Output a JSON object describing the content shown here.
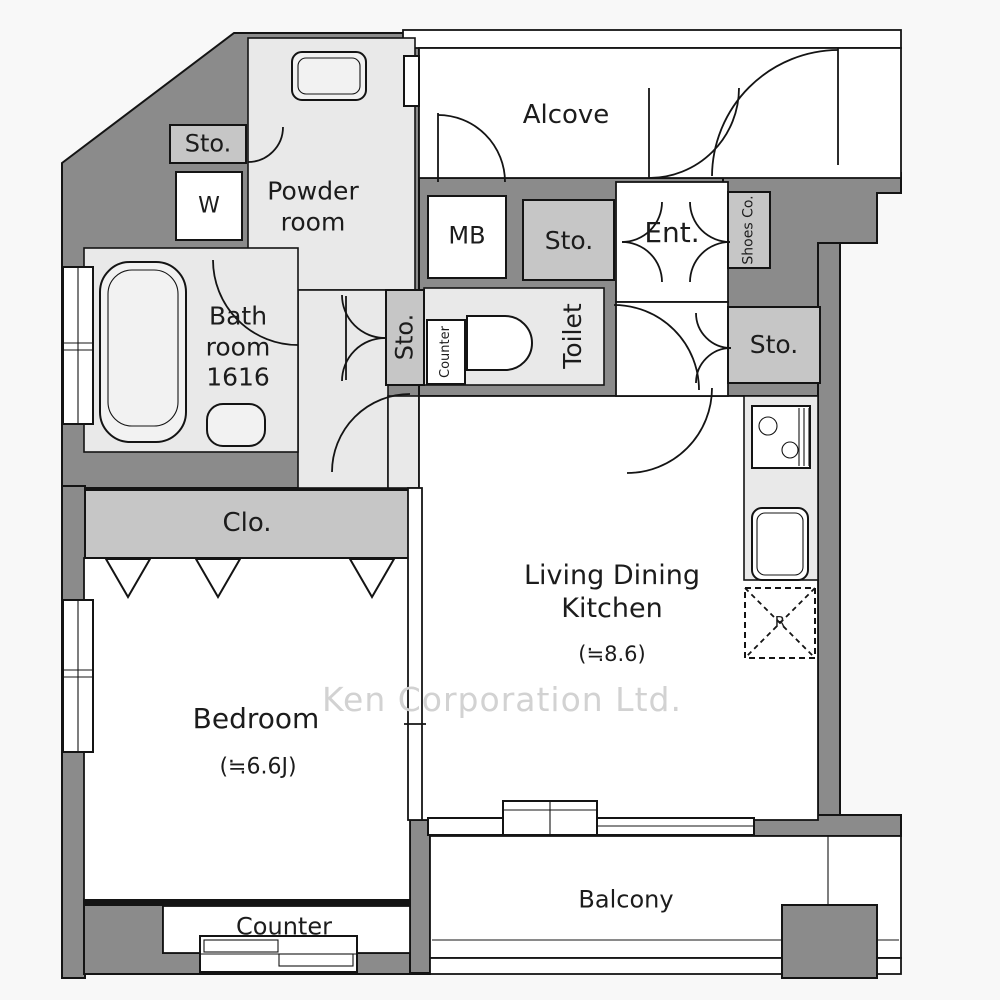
{
  "palette": {
    "wall": "#8b8b8b",
    "room": "#e9e9e9",
    "cabinet": "#c6c6c6",
    "white": "#ffffff",
    "line": "#141414",
    "background": "#f8f8f8",
    "watermark_color": "#d2d2d2",
    "text": "#1c1c1c"
  },
  "labels": {
    "alcove": "Alcove",
    "powder_room": "Powder room",
    "storage_top_left": "Sto.",
    "washing_machine": "W",
    "bathroom": "Bath room 1616",
    "meter_box": "MB",
    "storage_entrance": "Sto.",
    "entrance": "Ent.",
    "shoes_cabinet": "Shoes Co.",
    "storage_hall": "Sto.",
    "counter_hall": "Counter",
    "toilet": "Toilet",
    "storage_kitchen": "Sto.",
    "closet": "Clo.",
    "living_dining_kitchen": "Living Dining Kitchen",
    "ldk_size": "(≒8.6)",
    "bedroom": "Bedroom",
    "bedroom_size": "(≒6.6J)",
    "refrigerator": "R",
    "balcony": "Balcony",
    "counter_bedroom": "Counter",
    "watermark": "Ken Corporation Ltd."
  }
}
